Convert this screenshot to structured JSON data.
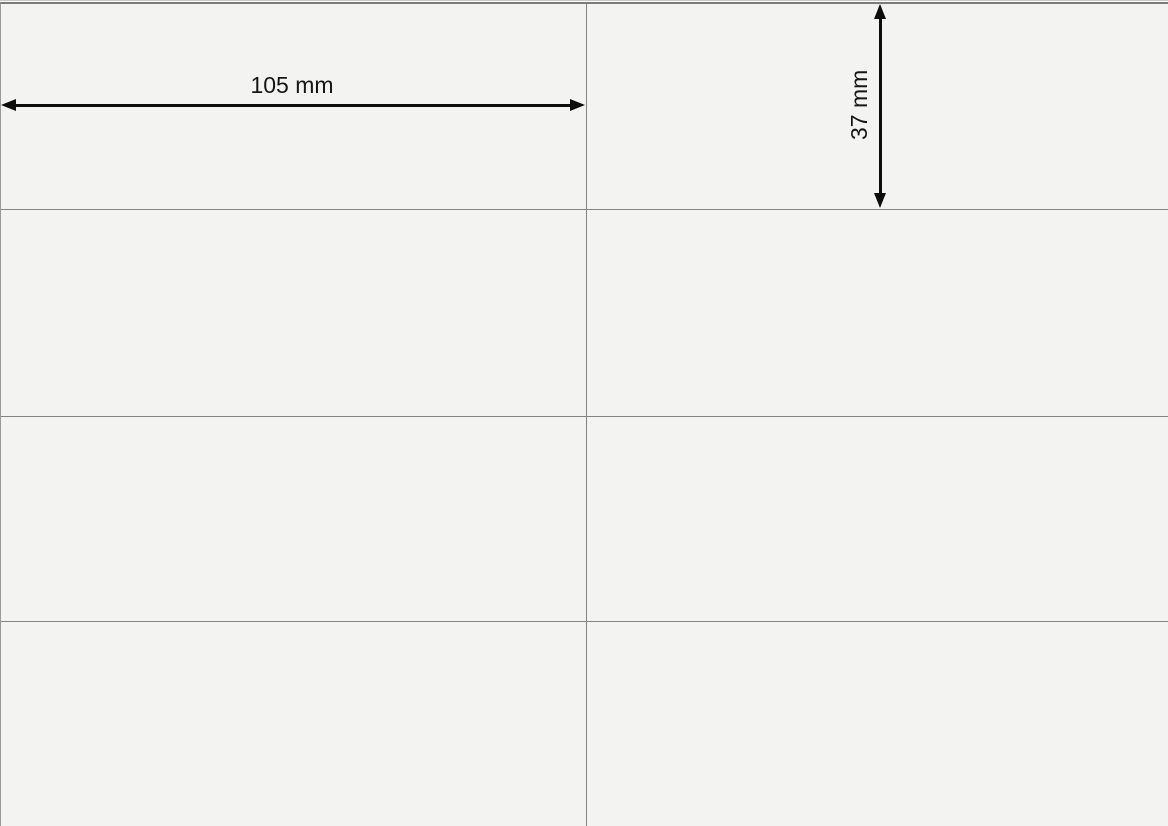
{
  "sheet": {
    "name": "label-sheet-template",
    "visible_columns": 2,
    "visible_rows": 4,
    "cell_count_visible": 8
  },
  "dimensions": {
    "width": {
      "label": "105 mm",
      "value": 105,
      "unit": "mm"
    },
    "height": {
      "label": "37 mm",
      "value": 37,
      "unit": "mm"
    }
  },
  "colors": {
    "paper": "#f3f3f1",
    "grid_line": "#838383",
    "top_border": "#7b7b7b",
    "arrow": "#0d0d0d",
    "text": "#161616"
  }
}
